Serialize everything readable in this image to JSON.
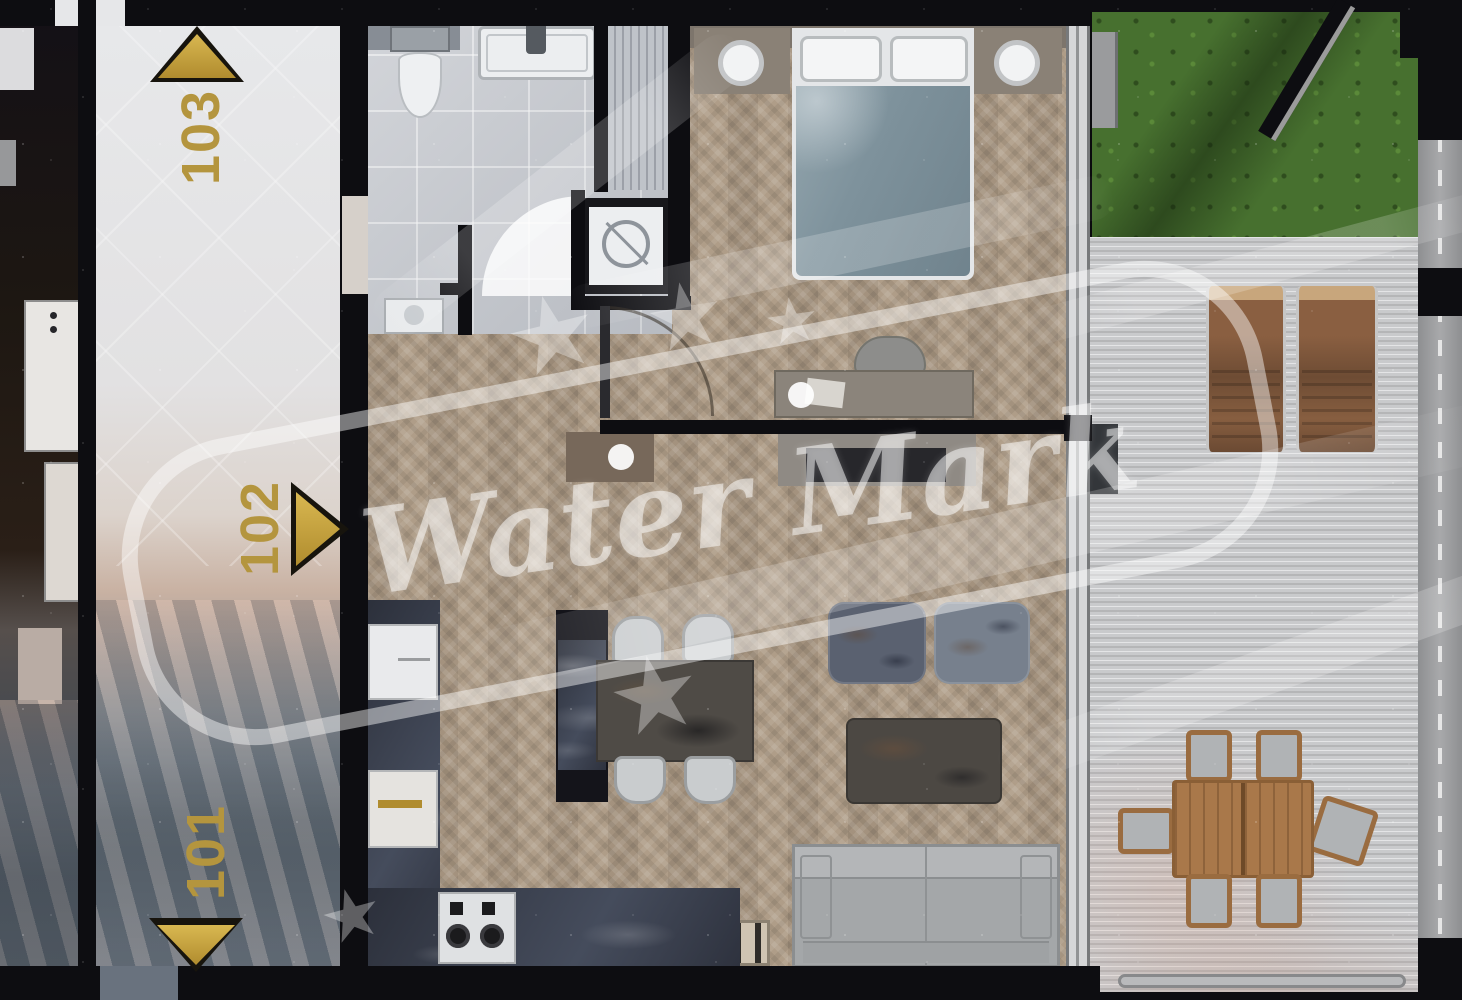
{
  "page": {
    "title": "Apartment floor plan — top-view render"
  },
  "units": [
    {
      "id": "103",
      "arrow_direction": "up"
    },
    {
      "id": "102",
      "arrow_direction": "right"
    },
    {
      "id": "101",
      "arrow_direction": "down"
    }
  ],
  "watermark": {
    "text": "Water Mark",
    "style": "semi-transparent white italic script",
    "elements": [
      "rounded-rectangle-outline",
      "stars",
      "sparkle-dots",
      "swoosh-bands"
    ]
  },
  "colors": {
    "wall": "#0d0d11",
    "unit_label_gold": "#b4953e",
    "arrow_gold": "#c9a63e",
    "herringbone_floor": "#b3a18c",
    "bathroom_tile": "#c6c9cf",
    "hallway_floor": "#e2e3e5",
    "deck": "#c9cacc",
    "grass": "#47702f",
    "kitchen_marble": "#353a47",
    "bed_duvet": "#7e929c",
    "sofa": "#a4a7a9",
    "outdoor_wood": "#a9784a"
  },
  "rooms": {
    "hallway": {
      "labels": [
        "103",
        "102",
        "101"
      ]
    },
    "bathroom": {
      "items": [
        "toilet",
        "bathtub",
        "shower",
        "washing-machine",
        "sink",
        "door-swing"
      ]
    },
    "bedroom": {
      "items": [
        "double-bed",
        "pillows",
        "nightstands",
        "lamps",
        "desk",
        "desk-chair"
      ]
    },
    "living_room": {
      "items": [
        "tv-console",
        "tv",
        "poufs",
        "coffee-table",
        "sofa",
        "dining-table",
        "dining-chairs",
        "sideboard"
      ]
    },
    "kitchen": {
      "items": [
        "fridge",
        "oven",
        "cooktop",
        "marble-counter"
      ]
    },
    "terrace": {
      "items": [
        "grass",
        "wood-deck",
        "lounge-chairs",
        "outdoor-dining-table",
        "outdoor-chairs",
        "railing"
      ]
    }
  }
}
